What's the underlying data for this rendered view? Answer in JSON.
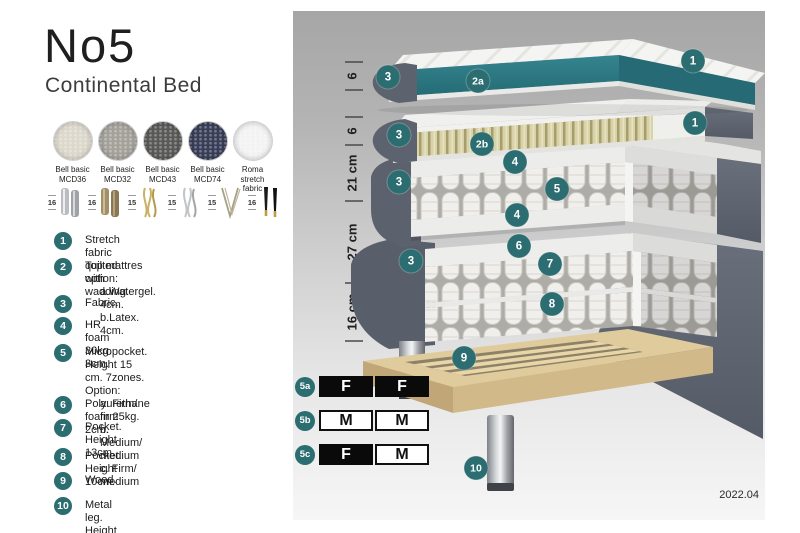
{
  "header": {
    "title": "No5",
    "subtitle": "Continental Bed"
  },
  "fabrics": [
    {
      "name": "Bell basic",
      "code": "MCD36",
      "color": "#ddd8cc"
    },
    {
      "name": "Bell basic",
      "code": "MCD32",
      "color": "#a3a19a"
    },
    {
      "name": "Bell basic",
      "code": "MCD43",
      "color": "#595957"
    },
    {
      "name": "Bell basic",
      "code": "MCD74",
      "color": "#383e57"
    },
    {
      "name": "Roma",
      "code": "stretch fabric",
      "color": "#f3f3f3"
    }
  ],
  "leg_options": [
    {
      "height": "16",
      "type": "cylinder-silver"
    },
    {
      "height": "16",
      "type": "cylinder-bronze"
    },
    {
      "height": "15",
      "type": "twisted-gold"
    },
    {
      "height": "15",
      "type": "twisted-silver"
    },
    {
      "height": "15",
      "type": "hairpin"
    },
    {
      "height": "16",
      "type": "tapered-black-gold"
    }
  ],
  "spec_list": [
    {
      "num": "1",
      "lines": [
        "Stretch fabric quilted with wadding."
      ]
    },
    {
      "num": "2",
      "lines": [
        "Top mattres option:",
        "a.Watergel. 4cm.",
        "b.Latex. 4cm."
      ]
    },
    {
      "num": "3",
      "lines": [
        "Fabric."
      ]
    },
    {
      "num": "4",
      "lines": [
        "HR foam 30kg. 3cm."
      ]
    },
    {
      "num": "5",
      "lines": [
        "Micropocket. Height 15 cm. 7zones. Option:",
        "a. Firm/ firm",
        "b. Medium/ medium",
        "c. Firm/ medium"
      ]
    },
    {
      "num": "6",
      "lines": [
        "Polyurethane foam 25kg. 2cm."
      ]
    },
    {
      "num": "7",
      "lines": [
        "Pocket. Height 13cm."
      ]
    },
    {
      "num": "8",
      "lines": [
        "Pocket. Height 10cm."
      ]
    },
    {
      "num": "9",
      "lines": [
        "Wood."
      ]
    },
    {
      "num": "10",
      "lines": [
        "Metal leg. Height 16cm."
      ]
    }
  ],
  "diagram": {
    "measurements": [
      "6",
      "6",
      "21 cm",
      "27 cm",
      "16 cm"
    ],
    "badge_labels": [
      "1",
      "2a",
      "3",
      "1",
      "2b",
      "3",
      "3",
      "4",
      "5",
      "4",
      "3",
      "6",
      "7",
      "8",
      "9",
      "10"
    ],
    "firmness_rows": [
      {
        "label": "5a",
        "cells": [
          {
            "letter": "F",
            "style": "dark"
          },
          {
            "letter": "F",
            "style": "dark"
          }
        ]
      },
      {
        "label": "5b",
        "cells": [
          {
            "letter": "M",
            "style": "light"
          },
          {
            "letter": "M",
            "style": "light"
          }
        ]
      },
      {
        "label": "5c",
        "cells": [
          {
            "letter": "F",
            "style": "dark"
          },
          {
            "letter": "M",
            "style": "light"
          }
        ]
      }
    ],
    "date": "2022.04"
  },
  "colors": {
    "badge": "#2b6d70",
    "watergel": "#2f7d89",
    "latex": "#d8d2a8",
    "slate": "#5d636e",
    "wood": "#e0cb9c",
    "table_dark": "#0a0a0a"
  }
}
